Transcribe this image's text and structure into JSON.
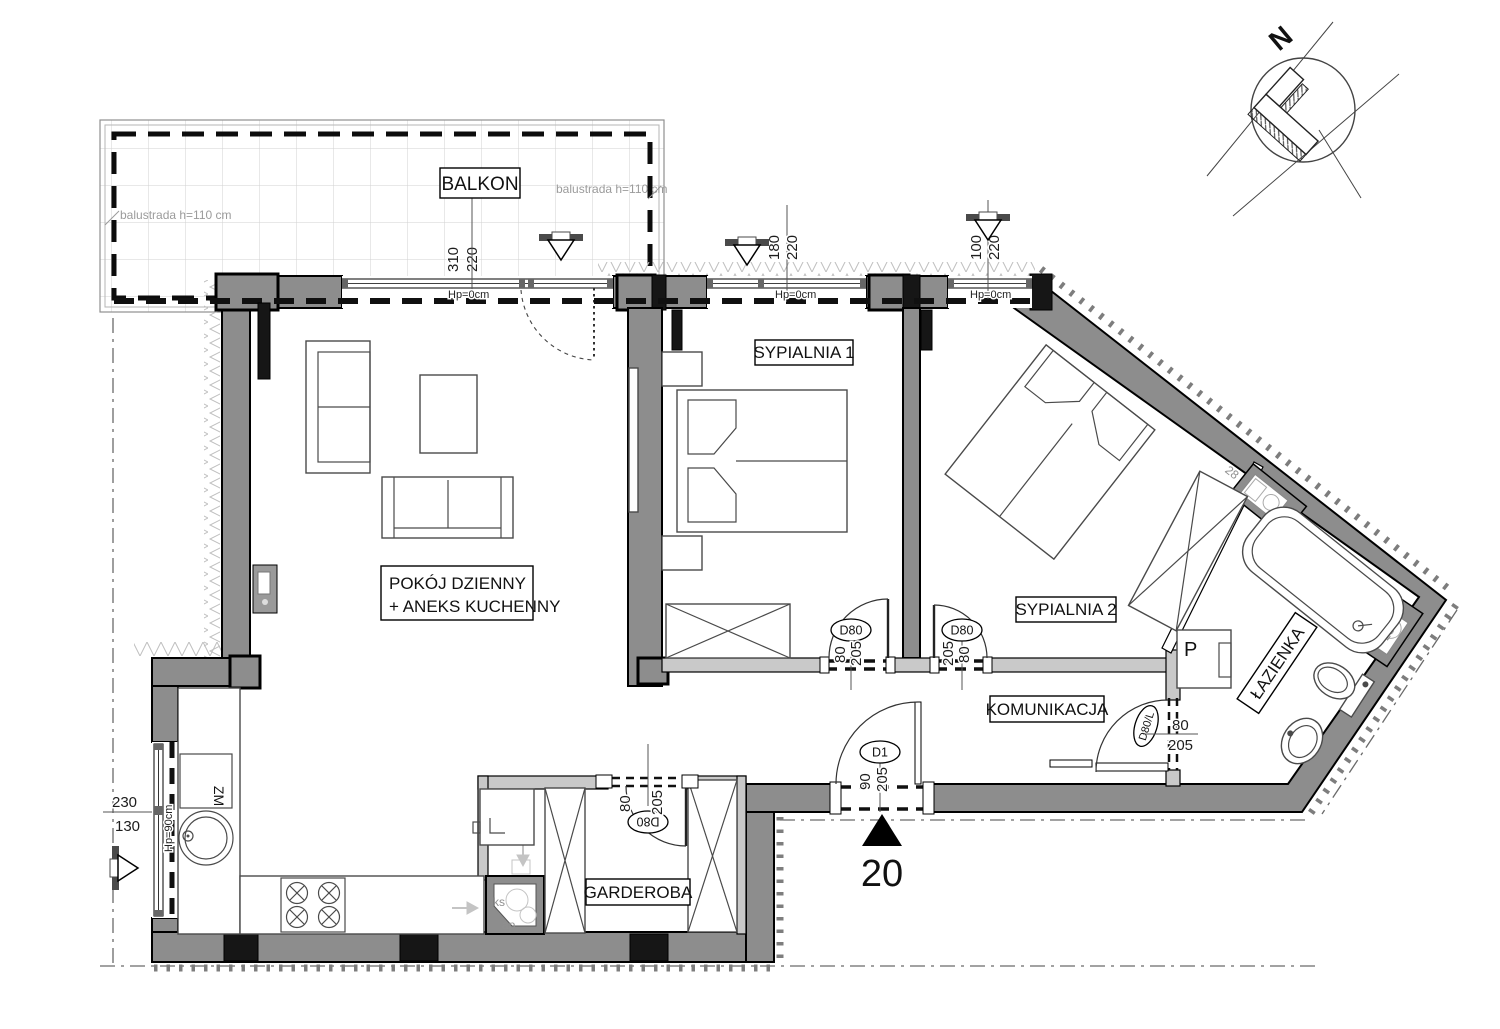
{
  "compass": {
    "north": "N"
  },
  "entry": {
    "number": "20"
  },
  "rooms": {
    "balkon": "BALKON",
    "living_line1": "POKÓJ DZIENNY",
    "living_line2": "+ ANEKS KUCHENNY",
    "bedroom1": "SYPIALNIA 1",
    "bedroom2": "SYPIALNIA 2",
    "hall": "KOMUNIKACJA",
    "bathroom": "ŁAZIENKA",
    "wardrobe": "GARDEROBA"
  },
  "balustrade": {
    "left": "balustrada h=110 cm",
    "right": "balustrada h=110 cm"
  },
  "windows": {
    "living": {
      "width": "310",
      "height": "220",
      "sill": "Hp=0cm"
    },
    "bedroom1": {
      "width": "180",
      "height": "220",
      "sill": "Hp=0cm"
    },
    "bedroom2": {
      "width": "100",
      "height": "220",
      "sill": "Hp=0cm"
    },
    "kitchen": {
      "width": "230",
      "height": "130",
      "sill": "Hp=90cm"
    }
  },
  "doors": {
    "bedroom1": {
      "code": "D80",
      "width": "80",
      "height": "205"
    },
    "bedroom2": {
      "code": "D80",
      "width": "80",
      "height": "205"
    },
    "wardrobe": {
      "code": "D80",
      "width": "80",
      "height": "205"
    },
    "bathroom": {
      "code": "D80/L",
      "width": "80",
      "height": "205"
    },
    "entry": {
      "code": "D1",
      "width": "90",
      "height": "205"
    }
  },
  "equipment": {
    "dishwasher": "ZM",
    "washer": "P",
    "shaft_ks": "ks",
    "shaft_ap": "ap",
    "shaft_upper": "28",
    "shaft_lower": "28"
  }
}
